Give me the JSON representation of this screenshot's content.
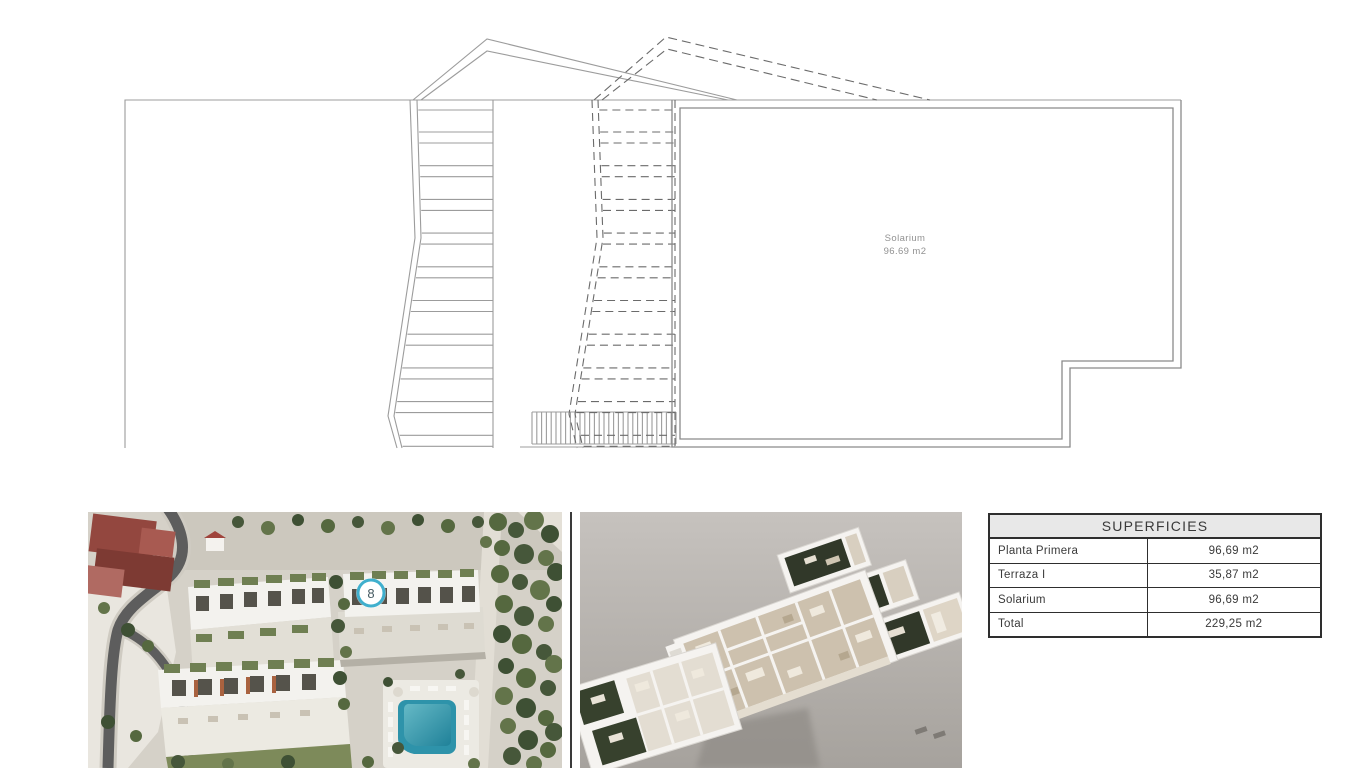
{
  "floor_plan": {
    "room_label": "Solarium",
    "room_area": "96.69 m2"
  },
  "aerial_photo": {
    "unit_badge": "8",
    "badge_ring_color": "#3fafcd",
    "pool_color": "#2e93aa"
  },
  "surfaces_table": {
    "title": "SUPERFICIES",
    "rows": [
      {
        "label": "Planta Primera",
        "value": "96,69 m2"
      },
      {
        "label": "Terraza I",
        "value": "35,87 m2"
      },
      {
        "label": "Solarium",
        "value": "96,69 m2"
      },
      {
        "label": "Total",
        "value": "229,25 m2"
      }
    ]
  }
}
